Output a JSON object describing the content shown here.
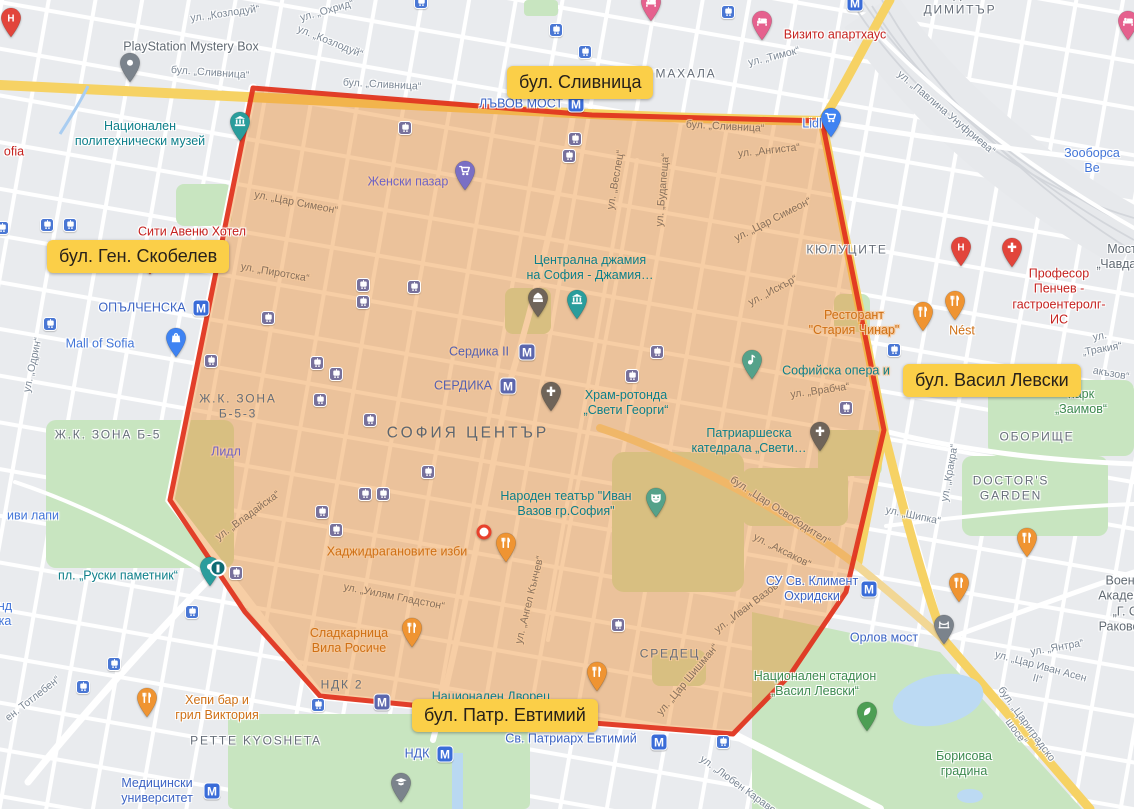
{
  "colors": {
    "region_fill": "rgba(238,140,45,0.45)",
    "region_border": "#e1351f",
    "badge_bg": "#fbcf48",
    "road_major": "#f6d264"
  },
  "metro_letter": "М",
  "region": {
    "points": [
      [
        253,
        88
      ],
      [
        592,
        115
      ],
      [
        822,
        121
      ],
      [
        884,
        430
      ],
      [
        846,
        592
      ],
      [
        790,
        675
      ],
      [
        733,
        734
      ],
      [
        593,
        723
      ],
      [
        320,
        696
      ],
      [
        245,
        612
      ],
      [
        170,
        500
      ]
    ]
  },
  "marker": {
    "x": 484,
    "y": 532
  },
  "badges": [
    {
      "text": "бул. Сливница",
      "x": 507,
      "y": 66
    },
    {
      "text": "бул. Ген. Скобелев",
      "x": 47,
      "y": 240
    },
    {
      "text": "бул. Васил Левски",
      "x": 903,
      "y": 364
    },
    {
      "text": "бул. Патр. Евтимий",
      "x": 412,
      "y": 699
    }
  ],
  "labels": [
    {
      "t": "ул. „Козлодуй“",
      "x": 225,
      "y": 14,
      "c": "street",
      "r": -8
    },
    {
      "t": "ул. „Охрид“",
      "x": 327,
      "y": 11,
      "c": "street",
      "r": -16
    },
    {
      "t": "ул. „Козлодуй“",
      "x": 330,
      "y": 42,
      "c": "street",
      "r": 22
    },
    {
      "t": "бул. „Сливница“",
      "x": 210,
      "y": 73,
      "c": "street",
      "r": 4
    },
    {
      "t": "бул. „Сливница“",
      "x": 382,
      "y": 85,
      "c": "street",
      "r": 3
    },
    {
      "t": "ул. „Тимок“",
      "x": 774,
      "y": 57,
      "c": "street",
      "r": -14
    },
    {
      "t": "ул. „Павлина Унуфриева“",
      "x": 946,
      "y": 113,
      "c": "street",
      "r": 40
    },
    {
      "t": "ул. „Одрин“",
      "x": 33,
      "y": 365,
      "c": "street",
      "r": -78
    },
    {
      "t": "ул. „Тракия“",
      "x": 1101,
      "y": 343,
      "c": "street",
      "r": -10
    },
    {
      "t": "акъзов“",
      "x": 1111,
      "y": 374,
      "c": "street",
      "r": 10
    },
    {
      "t": "ул. „Кракра“",
      "x": 950,
      "y": 473,
      "c": "street",
      "r": -80
    },
    {
      "t": "ул. „Шипка“",
      "x": 913,
      "y": 516,
      "c": "street",
      "r": 12
    },
    {
      "t": "ул. „Янтра“",
      "x": 1057,
      "y": 648,
      "c": "street",
      "r": -10
    },
    {
      "t": "ул. „Цар Иван Асен II“",
      "x": 1039,
      "y": 673,
      "c": "street",
      "r": 15
    },
    {
      "t": "бул. „Цариградско шосе“",
      "x": 1021,
      "y": 728,
      "c": "street",
      "r": 54
    },
    {
      "t": "ул. „Любен Каравелов“",
      "x": 746,
      "y": 791,
      "c": "street",
      "r": 36
    },
    {
      "t": "ен. Тотлебен“",
      "x": 33,
      "y": 699,
      "c": "street",
      "r": -38
    },
    {
      "t": "бул. „Сливница“",
      "x": 725,
      "y": 127,
      "c": "street",
      "r": 3,
      "in": true
    },
    {
      "t": "ул. „Ангиста“",
      "x": 769,
      "y": 151,
      "c": "street",
      "r": -6,
      "in": true
    },
    {
      "t": "ул. „Цар Симеон“",
      "x": 296,
      "y": 203,
      "c": "street",
      "r": 11,
      "in": true
    },
    {
      "t": "ул. „Цар Симеон“",
      "x": 773,
      "y": 220,
      "c": "street",
      "r": -27,
      "in": true
    },
    {
      "t": "ул. „Веслец“",
      "x": 616,
      "y": 180,
      "c": "street",
      "r": -80,
      "in": true
    },
    {
      "t": "ул. „Будапеща“",
      "x": 663,
      "y": 190,
      "c": "street",
      "r": -85,
      "in": true
    },
    {
      "t": "ул. „Искър“",
      "x": 773,
      "y": 291,
      "c": "street",
      "r": -28,
      "in": true
    },
    {
      "t": "ул. „Пиротска“",
      "x": 275,
      "y": 273,
      "c": "street",
      "r": 10,
      "in": true
    },
    {
      "t": "ул. „Владайска“",
      "x": 248,
      "y": 516,
      "c": "street",
      "r": -36,
      "in": true
    },
    {
      "t": "ул. „Врабча“",
      "x": 820,
      "y": 391,
      "c": "street",
      "r": -8,
      "in": true
    },
    {
      "t": "бул. „Цар Освободител“",
      "x": 780,
      "y": 511,
      "c": "street",
      "r": 33,
      "in": true
    },
    {
      "t": "ул. „Аксаков“",
      "x": 782,
      "y": 551,
      "c": "street",
      "r": 27,
      "in": true
    },
    {
      "t": "ул. „Уилям Гладстон“",
      "x": 394,
      "y": 597,
      "c": "street",
      "r": 11,
      "in": true
    },
    {
      "t": "ул. „Ангел Кънчев“",
      "x": 530,
      "y": 600,
      "c": "street",
      "r": -76,
      "in": true
    },
    {
      "t": "ул. „Цар Шишман“",
      "x": 688,
      "y": 680,
      "c": "street",
      "r": -50,
      "in": true
    },
    {
      "t": "ул. „Иван Вазов“",
      "x": 748,
      "y": 607,
      "c": "street",
      "r": -37,
      "in": true
    },
    {
      "t": "МАХАЛА",
      "x": 686,
      "y": 74,
      "c": "area"
    },
    {
      "t": "ХАДЖИ\nДИМИТЪР",
      "x": 960,
      "y": 2,
      "c": "area"
    },
    {
      "t": "КЮЛУЦИТЕ",
      "x": 847,
      "y": 250,
      "c": "area"
    },
    {
      "t": "СОФИЯ ЦЕНТЪР",
      "x": 468,
      "y": 434,
      "c": "area-big",
      "in": true
    },
    {
      "t": "Ж.К. ЗОНА Б-5",
      "x": 108,
      "y": 435,
      "c": "area"
    },
    {
      "t": "Ж.К. ЗОНА\nБ-5-3",
      "x": 238,
      "y": 406,
      "c": "area",
      "in": true
    },
    {
      "t": "СРЕДЕЦ",
      "x": 670,
      "y": 654,
      "c": "area",
      "in": true
    },
    {
      "t": "ОБОРИЩЕ",
      "x": 1037,
      "y": 437,
      "c": "area"
    },
    {
      "t": "DOCTOR'S\nGARDEN",
      "x": 1011,
      "y": 488,
      "c": "area"
    },
    {
      "t": "PETTE KYOSHETA",
      "x": 256,
      "y": 741,
      "c": "area"
    },
    {
      "t": "НДК 2",
      "x": 342,
      "y": 685,
      "c": "area",
      "in": true
    },
    {
      "t": "Мост „Чавдар“",
      "x": 1122,
      "y": 257,
      "c": "poi-gray"
    },
    {
      "t": "ЛЪВОВ МОСТ",
      "x": 521,
      "y": 104,
      "c": "transit"
    },
    {
      "t": "ОПЪЛЧЕНСКА",
      "x": 142,
      "y": 308,
      "c": "transit"
    },
    {
      "t": "Сердика II",
      "x": 479,
      "y": 352,
      "c": "transit",
      "in": true
    },
    {
      "t": "СЕРДИКА",
      "x": 463,
      "y": 386,
      "c": "transit",
      "in": true
    },
    {
      "t": "НДК",
      "x": 417,
      "y": 754,
      "c": "transit"
    },
    {
      "t": "Св. Патриарх Евтимий",
      "x": 571,
      "y": 739,
      "c": "transit"
    },
    {
      "t": "Медицински\nуниверситет",
      "x": 157,
      "y": 791,
      "c": "transit"
    },
    {
      "t": "СУ Св. Климент\nОхридски",
      "x": 812,
      "y": 589,
      "c": "transit"
    },
    {
      "t": "Орлов мост",
      "x": 884,
      "y": 638,
      "c": "transit"
    },
    {
      "t": "пл. „Руски паметник“",
      "x": 118,
      "y": 576,
      "c": "poi-teal"
    },
    {
      "t": "PlayStation Mystery Box",
      "x": 191,
      "y": 47,
      "c": "poi-gray"
    },
    {
      "t": "Национален\nполитехнически музей",
      "x": 140,
      "y": 134,
      "c": "poi-teal"
    },
    {
      "t": "ofia",
      "x": 14,
      "y": 152,
      "c": "poi-red"
    },
    {
      "t": "Сити Авеню Хотел",
      "x": 192,
      "y": 232,
      "c": "poi-red"
    },
    {
      "t": "Визито апартхаус",
      "x": 835,
      "y": 35,
      "c": "poi-red"
    },
    {
      "t": "Професор Пенчев -\nгастроентеролг- ИС",
      "x": 1059,
      "y": 297,
      "c": "poi-red"
    },
    {
      "t": "Зооборса Ве",
      "x": 1092,
      "y": 161,
      "c": "poi-blue"
    },
    {
      "t": "Женски пазар",
      "x": 408,
      "y": 182,
      "c": "poi-indigo",
      "in": true
    },
    {
      "t": "Лидл",
      "x": 226,
      "y": 452,
      "c": "poi-indigo",
      "in": true
    },
    {
      "t": "Lidl",
      "x": 812,
      "y": 124,
      "c": "poi-blue"
    },
    {
      "t": "Mall of Sofia",
      "x": 100,
      "y": 344,
      "c": "poi-blue"
    },
    {
      "t": "Централна джамия\nна София - Джамия…",
      "x": 590,
      "y": 268,
      "c": "poi-teal",
      "in": true
    },
    {
      "t": "Храм-ротонда\n„Свети Георги“",
      "x": 626,
      "y": 403,
      "c": "poi-teal",
      "in": true
    },
    {
      "t": "Патриаршеска\nкатедрала „Свети…",
      "x": 749,
      "y": 441,
      "c": "poi-teal",
      "in": true
    },
    {
      "t": "Софийска опера и",
      "x": 836,
      "y": 371,
      "c": "poi-teal",
      "in": true
    },
    {
      "t": "Народен театър \"Иван\nВазов гр.София\"",
      "x": 566,
      "y": 504,
      "c": "poi-teal",
      "in": true
    },
    {
      "t": "Национален Дворец",
      "x": 491,
      "y": 697,
      "c": "poi-teal",
      "in": true
    },
    {
      "t": "Хаджидрагановите изби",
      "x": 397,
      "y": 552,
      "c": "poi-orange",
      "in": true
    },
    {
      "t": "Сладкарница\nВила Росиче",
      "x": 349,
      "y": 641,
      "c": "poi-orange",
      "in": true
    },
    {
      "t": "Хепи бар и\nгрил Виктория",
      "x": 217,
      "y": 708,
      "c": "poi-orange"
    },
    {
      "t": "Ресторант\n\"Стария Чинар\"",
      "x": 854,
      "y": 323,
      "c": "poi-orange",
      "in": true
    },
    {
      "t": "Nést",
      "x": 962,
      "y": 331,
      "c": "poi-orange"
    },
    {
      "t": "парк „Заимов“",
      "x": 1081,
      "y": 402,
      "c": "poi-green"
    },
    {
      "t": "Национален стадион\n„Васил Левски“",
      "x": 815,
      "y": 684,
      "c": "poi-green"
    },
    {
      "t": "Борисова\nградина",
      "x": 964,
      "y": 764,
      "c": "poi-green"
    },
    {
      "t": "Военна Академия\n„Г. С. Раковски“",
      "x": 1127,
      "y": 604,
      "c": "poi-gray"
    },
    {
      "t": "иви лапи",
      "x": 33,
      "y": 516,
      "c": "poi-blue"
    },
    {
      "t": "нд\nка",
      "x": 5,
      "y": 614,
      "c": "poi-blue"
    }
  ],
  "metro_icons": [
    {
      "x": 576,
      "y": 104
    },
    {
      "x": 201,
      "y": 308
    },
    {
      "x": 527,
      "y": 352,
      "in": true
    },
    {
      "x": 508,
      "y": 386,
      "in": true
    },
    {
      "x": 869,
      "y": 589
    },
    {
      "x": 659,
      "y": 742
    },
    {
      "x": 445,
      "y": 754
    },
    {
      "x": 212,
      "y": 791
    },
    {
      "x": 382,
      "y": 702,
      "in": true
    },
    {
      "x": 855,
      "y": 3
    }
  ],
  "tram_icons": [
    {
      "x": 47,
      "y": 225
    },
    {
      "x": 70,
      "y": 225
    },
    {
      "x": 2,
      "y": 228
    },
    {
      "x": 50,
      "y": 324
    },
    {
      "x": 192,
      "y": 612
    },
    {
      "x": 114,
      "y": 664
    },
    {
      "x": 83,
      "y": 687
    },
    {
      "x": 318,
      "y": 705
    },
    {
      "x": 723,
      "y": 742
    },
    {
      "x": 894,
      "y": 350
    },
    {
      "x": 556,
      "y": 30
    },
    {
      "x": 585,
      "y": 52
    },
    {
      "x": 728,
      "y": 12
    },
    {
      "x": 421,
      "y": 2
    },
    {
      "x": 405,
      "y": 128,
      "in": true
    },
    {
      "x": 575,
      "y": 139,
      "in": true
    },
    {
      "x": 569,
      "y": 156,
      "in": true
    },
    {
      "x": 363,
      "y": 285,
      "in": true
    },
    {
      "x": 363,
      "y": 302,
      "in": true
    },
    {
      "x": 414,
      "y": 287,
      "in": true
    },
    {
      "x": 268,
      "y": 318,
      "in": true
    },
    {
      "x": 211,
      "y": 361,
      "in": true
    },
    {
      "x": 317,
      "y": 363,
      "in": true
    },
    {
      "x": 336,
      "y": 374,
      "in": true
    },
    {
      "x": 370,
      "y": 420,
      "in": true
    },
    {
      "x": 320,
      "y": 400,
      "in": true
    },
    {
      "x": 428,
      "y": 472,
      "in": true
    },
    {
      "x": 632,
      "y": 376,
      "in": true
    },
    {
      "x": 657,
      "y": 352,
      "in": true
    },
    {
      "x": 846,
      "y": 408,
      "in": true
    },
    {
      "x": 365,
      "y": 494,
      "in": true
    },
    {
      "x": 383,
      "y": 494,
      "in": true
    },
    {
      "x": 322,
      "y": 512,
      "in": true
    },
    {
      "x": 336,
      "y": 530,
      "in": true
    },
    {
      "x": 618,
      "y": 625,
      "in": true
    },
    {
      "x": 236,
      "y": 573,
      "in": true
    }
  ],
  "pins": [
    {
      "t": "hospital",
      "x": 11,
      "y": 43
    },
    {
      "t": "dot-gray",
      "x": 130,
      "y": 88
    },
    {
      "t": "hotel",
      "x": 651,
      "y": 27
    },
    {
      "t": "hotel",
      "x": 762,
      "y": 46
    },
    {
      "t": "hotel",
      "x": 1128,
      "y": 46
    },
    {
      "t": "cart-blue",
      "x": 831,
      "y": 143
    },
    {
      "t": "museum",
      "x": 240,
      "y": 147
    },
    {
      "t": "bag",
      "x": 176,
      "y": 363
    },
    {
      "t": "cart",
      "x": 465,
      "y": 196
    },
    {
      "t": "mosque",
      "x": 538,
      "y": 323
    },
    {
      "t": "museum",
      "x": 577,
      "y": 325
    },
    {
      "t": "church",
      "x": 551,
      "y": 417
    },
    {
      "t": "church",
      "x": 820,
      "y": 457
    },
    {
      "t": "music",
      "x": 752,
      "y": 385
    },
    {
      "t": "theater",
      "x": 656,
      "y": 523
    },
    {
      "t": "restaurant",
      "x": 923,
      "y": 337
    },
    {
      "t": "restaurant",
      "x": 955,
      "y": 326
    },
    {
      "t": "restaurant",
      "x": 506,
      "y": 568
    },
    {
      "t": "restaurant",
      "x": 412,
      "y": 653
    },
    {
      "t": "restaurant",
      "x": 147,
      "y": 723
    },
    {
      "t": "restaurant",
      "x": 597,
      "y": 697
    },
    {
      "t": "restaurant",
      "x": 959,
      "y": 608
    },
    {
      "t": "restaurant",
      "x": 1027,
      "y": 563
    },
    {
      "t": "hospital",
      "x": 961,
      "y": 272
    },
    {
      "t": "clinic",
      "x": 1012,
      "y": 273
    },
    {
      "t": "grad",
      "x": 401,
      "y": 808
    },
    {
      "t": "bridge",
      "x": 944,
      "y": 650
    },
    {
      "t": "monument",
      "x": 210,
      "y": 592
    },
    {
      "t": "park",
      "x": 867,
      "y": 737
    },
    {
      "t": "mini",
      "x": 150,
      "y": 280
    }
  ]
}
